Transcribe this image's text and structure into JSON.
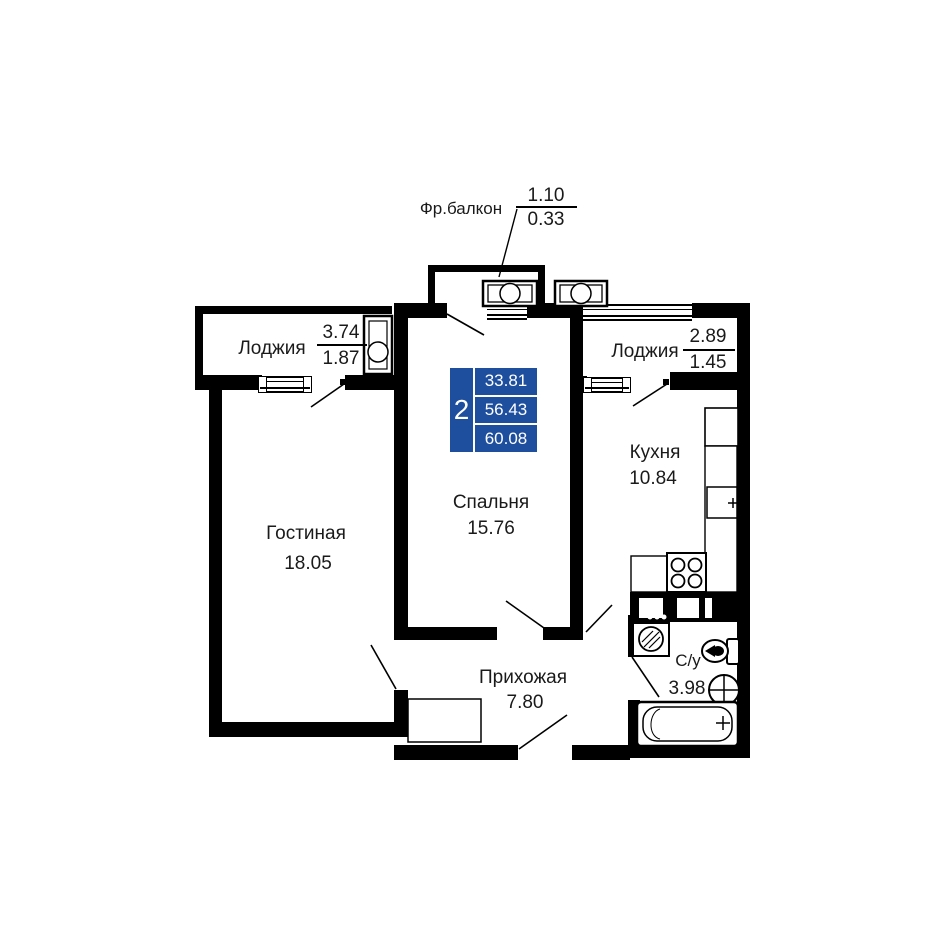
{
  "plan": {
    "wall_color": "#000000",
    "accent_blue": "#1e4f9e"
  },
  "rooms": {
    "fr_balcony": {
      "label": "Фр.балкон",
      "area_full": "1.10",
      "area_reduced": "0.33"
    },
    "loggia_left": {
      "label": "Лоджия",
      "area_full": "3.74",
      "area_reduced": "1.87"
    },
    "loggia_right": {
      "label": "Лоджия",
      "area_full": "2.89",
      "area_reduced": "1.45"
    },
    "bedroom": {
      "label": "Спальня",
      "area": "15.76"
    },
    "kitchen": {
      "label": "Кухня",
      "area": "10.84"
    },
    "living_room": {
      "label": "Гостиная",
      "area": "18.05"
    },
    "hallway": {
      "label": "Прихожая",
      "area": "7.80"
    },
    "bathroom": {
      "label": "С/у",
      "area": "3.98"
    }
  },
  "summary": {
    "room_count": "2",
    "living_area": "33.81",
    "apartment_area": "56.43",
    "total_area": "60.08"
  }
}
